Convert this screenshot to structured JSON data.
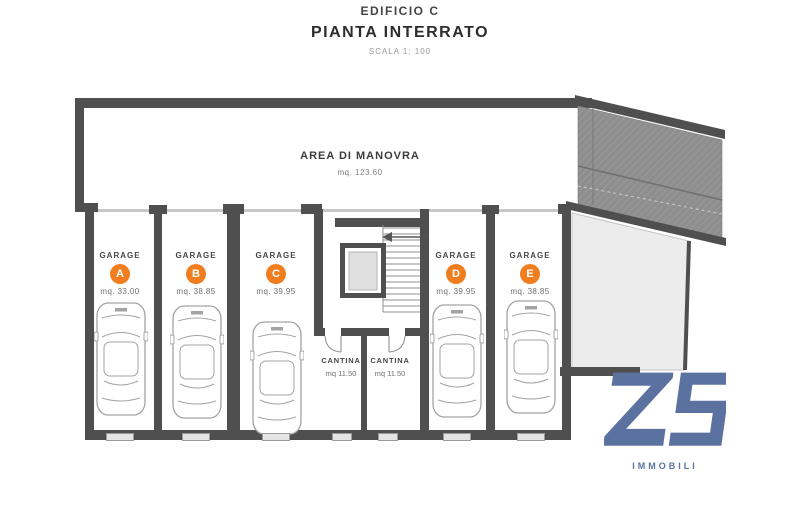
{
  "title": {
    "building": "EDIFICIO C",
    "plan": "PIANTA INTERRATO",
    "scale": "SCALA 1: 100"
  },
  "areas": {
    "manovra": {
      "label": "AREA DI MANOVRA",
      "size": "mq. 123.60"
    },
    "garages": [
      {
        "label": "GARAGE",
        "letter": "A",
        "size": "mq. 33.00"
      },
      {
        "label": "GARAGE",
        "letter": "B",
        "size": "mq. 38.85"
      },
      {
        "label": "GARAGE",
        "letter": "C",
        "size": "mq. 39.95"
      },
      {
        "label": "GARAGE",
        "letter": "D",
        "size": "mq. 39.95"
      },
      {
        "label": "GARAGE",
        "letter": "E",
        "size": "mq. 38.85"
      }
    ],
    "cantinas": [
      {
        "label": "CANTINA",
        "size": "mq 11.50"
      },
      {
        "label": "CANTINA",
        "size": "mq 11.50"
      }
    ]
  },
  "logo": {
    "monogram": "ZS",
    "text": "IMMOBILI"
  },
  "colors": {
    "wall": "#4f4f50",
    "accent_orange": "#f07d1e",
    "logo_blue": "#5b72a0",
    "courtyard_gray": "#ececec",
    "ramp_gray": "#8e8e8e"
  }
}
